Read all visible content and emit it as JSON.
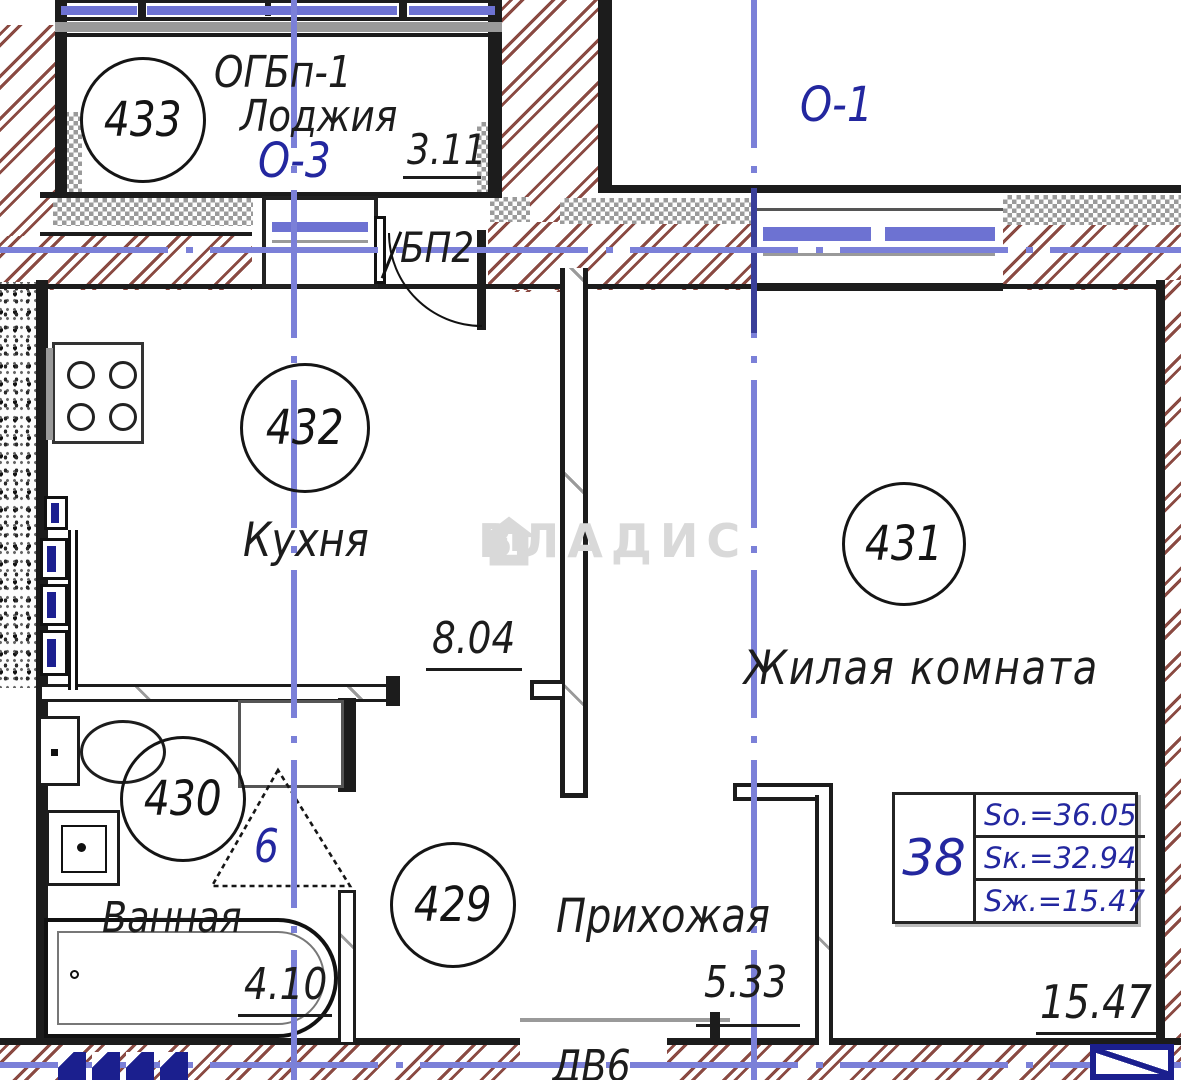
{
  "colors": {
    "wall": "#1c1c1c",
    "hatch": "#8a4a42",
    "axis": "#7b80d8",
    "glazing": "#6d72d2",
    "navy": "#23279f",
    "watermark": "#d9d9d9"
  },
  "watermark": {
    "brand": "ВЛАДИС"
  },
  "loggia_left": {
    "number": "433",
    "window_label": "ОГБп-1",
    "name": "Лоджия",
    "axis_label": "О-3",
    "dim": "3.11"
  },
  "loggia_right": {
    "axis_label": "О-1"
  },
  "kitchen": {
    "number": "432",
    "name": "Кухня",
    "dim": "8.04"
  },
  "living_room": {
    "number": "431",
    "name": "Жилая комната",
    "dim": "15.47"
  },
  "bathroom": {
    "number": "430",
    "name": "Ванная",
    "dim": "4.10",
    "door_mark": "6"
  },
  "hallway": {
    "number": "429",
    "name": "Прихожая",
    "dim": "5.33"
  },
  "doors": {
    "balcony_door": "БП2",
    "entrance_door": "ДВ6"
  },
  "area_table": {
    "flat_number": "38",
    "rows": [
      "Sо.=36.05",
      "Sк.=32.94",
      "Sж.=15.47"
    ]
  }
}
